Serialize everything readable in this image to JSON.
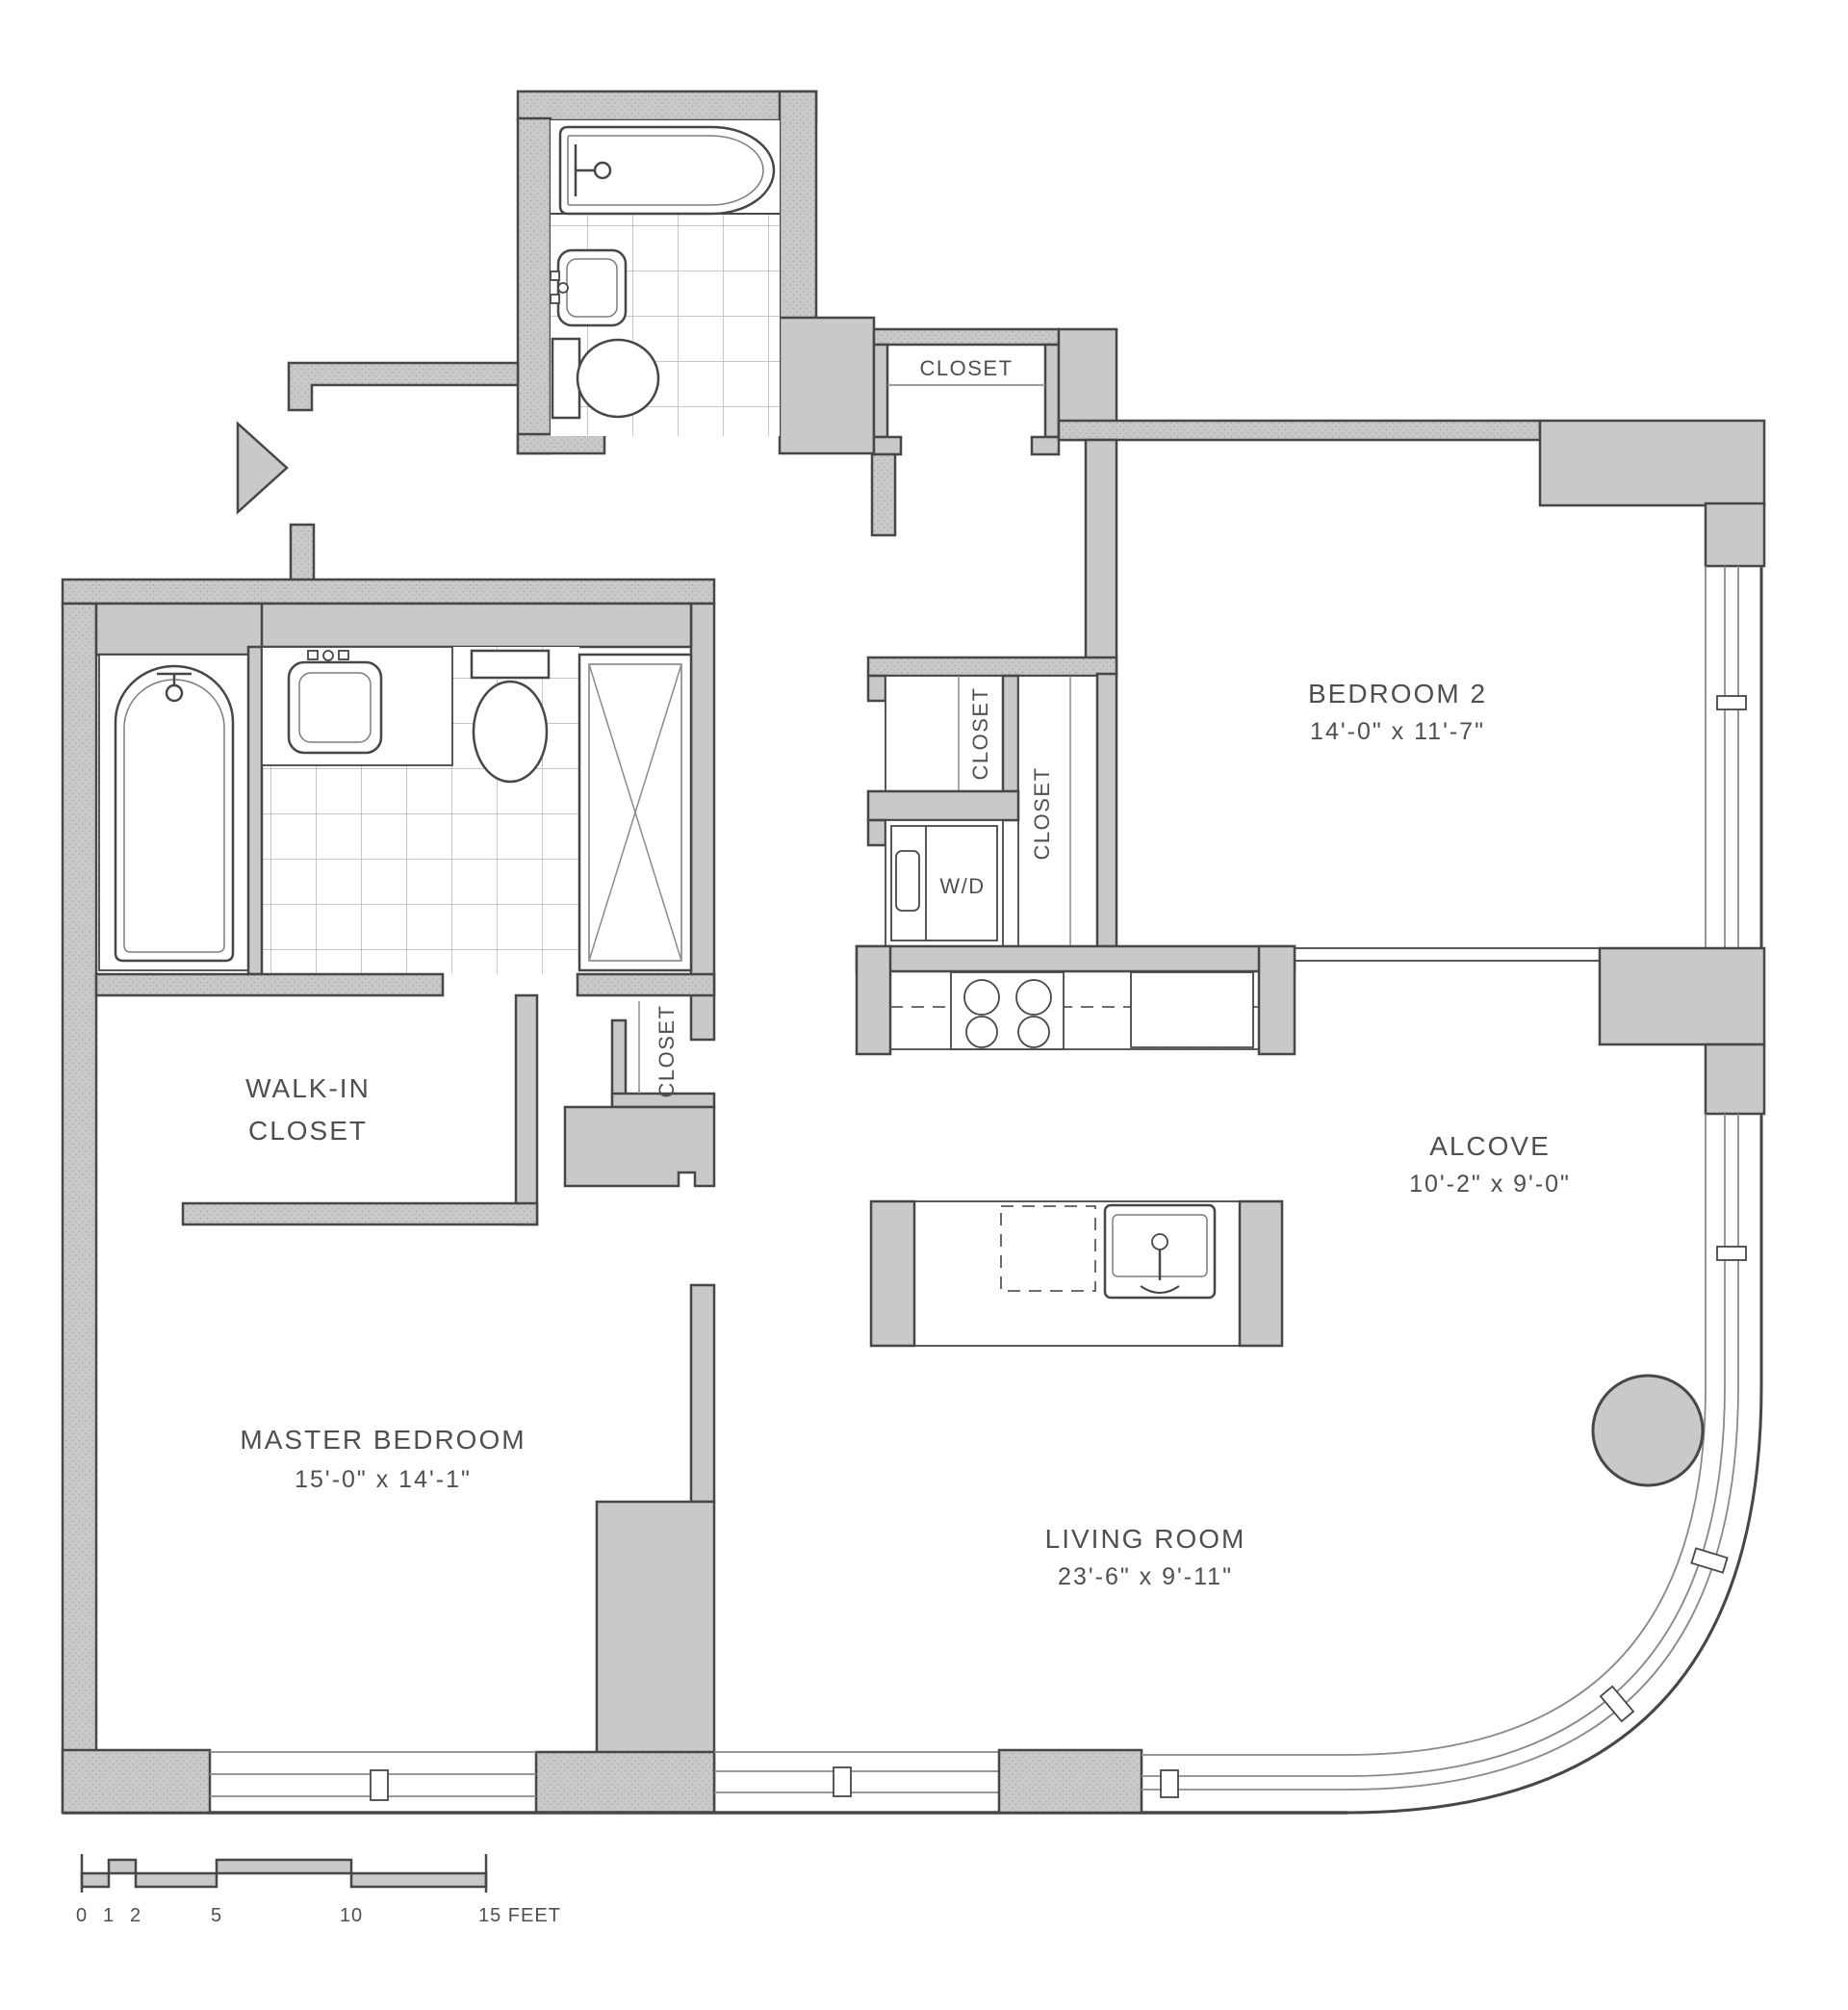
{
  "plan": {
    "rooms": {
      "bedroom2": {
        "name": "BEDROOM 2",
        "dims": "14'-0\" x 11'-7\""
      },
      "alcove": {
        "name": "ALCOVE",
        "dims": "10'-2\" x 9'-0\""
      },
      "living_room": {
        "name": "LIVING ROOM",
        "dims": "23'-6\" x 9'-11\""
      },
      "master_bedroom": {
        "name": "MASTER BEDROOM",
        "dims": "15'-0\" x 14'-1\""
      },
      "walk_in_closet": {
        "line1": "WALK-IN",
        "line2": "CLOSET"
      }
    },
    "closets": {
      "hall": "CLOSET",
      "bedroom2_a": "CLOSET",
      "bedroom2_b": "CLOSET",
      "master_hall": "CLOSET",
      "washer_dryer": "W/D"
    },
    "scale_bar": {
      "ticks": [
        "0",
        "1",
        "2",
        "5",
        "10"
      ],
      "end_label": "15 FEET"
    },
    "colors": {
      "wall": "#c9c9c9",
      "wall_texture_dot": "#a6a6a6",
      "line": "#474747",
      "line_light": "#8a8a8a",
      "tile_line": "#b6b6b6",
      "text": "#4f4f4f",
      "background": "#ffffff"
    }
  }
}
